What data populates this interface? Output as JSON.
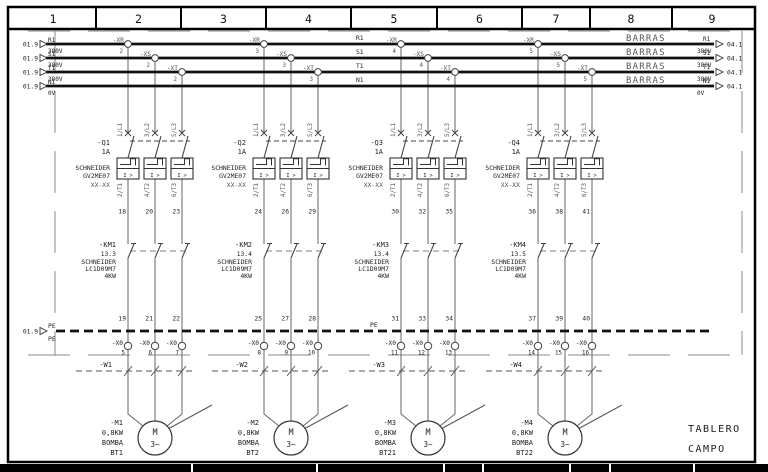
{
  "sheet": {
    "columns": [
      "1",
      "2",
      "3",
      "4",
      "5",
      "6",
      "7",
      "8",
      "9"
    ],
    "tablero": "TABLERO",
    "campo": "CAMPO"
  },
  "colors": {
    "paper": "#ffffff",
    "line_black": "#111111",
    "wire_gray": "#666666",
    "label_gray": "#555555",
    "symbol_gray": "#444444"
  },
  "bus_section": {
    "barras": "BARRAS",
    "src_ref": "01.9",
    "dst_ref": "04.1",
    "buses": [
      {
        "name": "R1",
        "voltage": "380V"
      },
      {
        "name": "S1",
        "voltage": "380V"
      },
      {
        "name": "T1",
        "voltage": "380V"
      },
      {
        "name": "N1",
        "voltage": "0V"
      }
    ],
    "pe": {
      "name": "PE",
      "label_top": "PE",
      "label_bottom": "PE",
      "mid_label": "PE",
      "src_ref": "01.9"
    }
  },
  "tap_names": [
    "-XR",
    "-XS",
    "-XT"
  ],
  "branches": [
    {
      "tap_number": "2",
      "breaker": {
        "tag": "-Q1",
        "rating": "1A",
        "brand": "SCHNEIDER",
        "model": "GV2ME07",
        "note": "XX-XX",
        "trip_label": "I >",
        "top_terminals": [
          "1/L1",
          "3/L2",
          "5/L3"
        ],
        "bottom_terminals": [
          "2/T1",
          "4/T2",
          "6/T3"
        ]
      },
      "upper_wires": [
        "18",
        "20",
        "23"
      ],
      "contactor": {
        "tag": "-KM1",
        "ref": "13.3",
        "brand": "SCHNEIDER",
        "model": "LC1D09M7",
        "power": "4KW"
      },
      "lower_wires": [
        "19",
        "21",
        "22"
      ],
      "terminal_tag": "-X0",
      "terminal_numbers": [
        "5",
        "6",
        "7"
      ],
      "cable": "-W1",
      "motor": {
        "tag": "-M1",
        "power": "0,8KW",
        "service": "BOMBA",
        "name": "BT1",
        "letter": "M",
        "phase": "3~"
      }
    },
    {
      "tap_number": "3",
      "breaker": {
        "tag": "-Q2",
        "rating": "1A",
        "brand": "SCHNEIDER",
        "model": "GV2ME07",
        "note": "XX-XX",
        "trip_label": "I >",
        "top_terminals": [
          "1/L1",
          "3/L2",
          "5/L3"
        ],
        "bottom_terminals": [
          "2/T1",
          "4/T2",
          "6/T3"
        ]
      },
      "upper_wires": [
        "24",
        "26",
        "29"
      ],
      "contactor": {
        "tag": "-KM2",
        "ref": "13.4",
        "brand": "SCHNEIDER",
        "model": "LC1D09M7",
        "power": "4KW"
      },
      "lower_wires": [
        "25",
        "27",
        "28"
      ],
      "terminal_tag": "-X0",
      "terminal_numbers": [
        "8",
        "9",
        "10"
      ],
      "cable": "-W2",
      "motor": {
        "tag": "-M2",
        "power": "0,8KW",
        "service": "BOMBA",
        "name": "BT2",
        "letter": "M",
        "phase": "3~"
      }
    },
    {
      "tap_number": "4",
      "breaker": {
        "tag": "-Q3",
        "rating": "1A",
        "brand": "SCHNEIDER",
        "model": "GV2ME07",
        "note": "XX-XX",
        "trip_label": "I >",
        "top_terminals": [
          "1/L1",
          "3/L2",
          "5/L3"
        ],
        "bottom_terminals": [
          "2/T1",
          "4/T2",
          "6/T3"
        ]
      },
      "upper_wires": [
        "30",
        "32",
        "35"
      ],
      "contactor": {
        "tag": "-KM3",
        "ref": "13.4",
        "brand": "SCHNEIDER",
        "model": "LC1D09M7",
        "power": "4KW"
      },
      "lower_wires": [
        "31",
        "33",
        "34"
      ],
      "terminal_tag": "-X0",
      "terminal_numbers": [
        "11",
        "12",
        "13"
      ],
      "cable": "-W3",
      "motor": {
        "tag": "-M3",
        "power": "0,8KW",
        "service": "BOMBA",
        "name": "BT21",
        "letter": "M",
        "phase": "3~"
      }
    },
    {
      "tap_number": "5",
      "breaker": {
        "tag": "-Q4",
        "rating": "1A",
        "brand": "SCHNEIDER",
        "model": "GV2ME07",
        "note": "XX-XX",
        "trip_label": "I >",
        "top_terminals": [
          "1/L1",
          "3/L2",
          "5/L3"
        ],
        "bottom_terminals": [
          "2/T1",
          "4/T2",
          "6/T3"
        ]
      },
      "upper_wires": [
        "36",
        "38",
        "41"
      ],
      "contactor": {
        "tag": "-KM4",
        "ref": "13.5",
        "brand": "SCHNEIDER",
        "model": "LC1D09M7",
        "power": "4KW"
      },
      "lower_wires": [
        "37",
        "39",
        "40"
      ],
      "terminal_tag": "-X0",
      "terminal_numbers": [
        "14",
        "15",
        "16"
      ],
      "cable": "-W4",
      "motor": {
        "tag": "-M4",
        "power": "0,8KW",
        "service": "BOMBA",
        "name": "BT22",
        "letter": "M",
        "phase": "3~"
      }
    }
  ]
}
